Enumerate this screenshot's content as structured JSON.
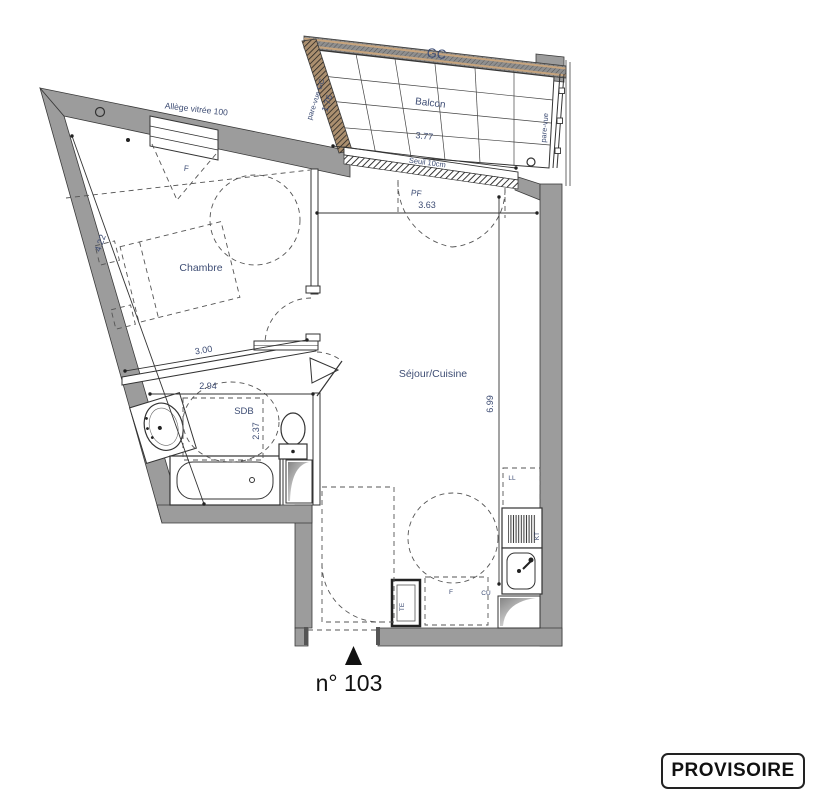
{
  "title_block": {
    "unit_number": "n° 103",
    "stamp": "PROVISOIRE"
  },
  "rooms": {
    "balcon": {
      "label": "Balcon",
      "beam": "GC",
      "width": "3.77",
      "threshold": "Seuil 10cm",
      "screen_left": "pare-vue GC",
      "screen_left_height": "1.76",
      "screen_right": "pare-vue"
    },
    "chambre": {
      "label": "Chambre",
      "window": "F",
      "window_note": "Allège vitrée 100",
      "width": "3.00",
      "length": "4.22"
    },
    "sejour": {
      "label": "Séjour/Cuisine",
      "bay": "PF",
      "width": "3.63",
      "length": "6.99"
    },
    "sdb": {
      "label": "SDB",
      "width": "2.94",
      "depth": "2.37"
    }
  },
  "equipment": {
    "washing_machine": "LL",
    "electrical_panel": "TE",
    "fridge": "F",
    "kitchen": "CU",
    "cooktop": "KT"
  },
  "colors": {
    "wall_gray": "#9c9c9c",
    "label_blue": "#3e4d74",
    "wood_tan": "#c6a47e",
    "ink": "#111111"
  }
}
